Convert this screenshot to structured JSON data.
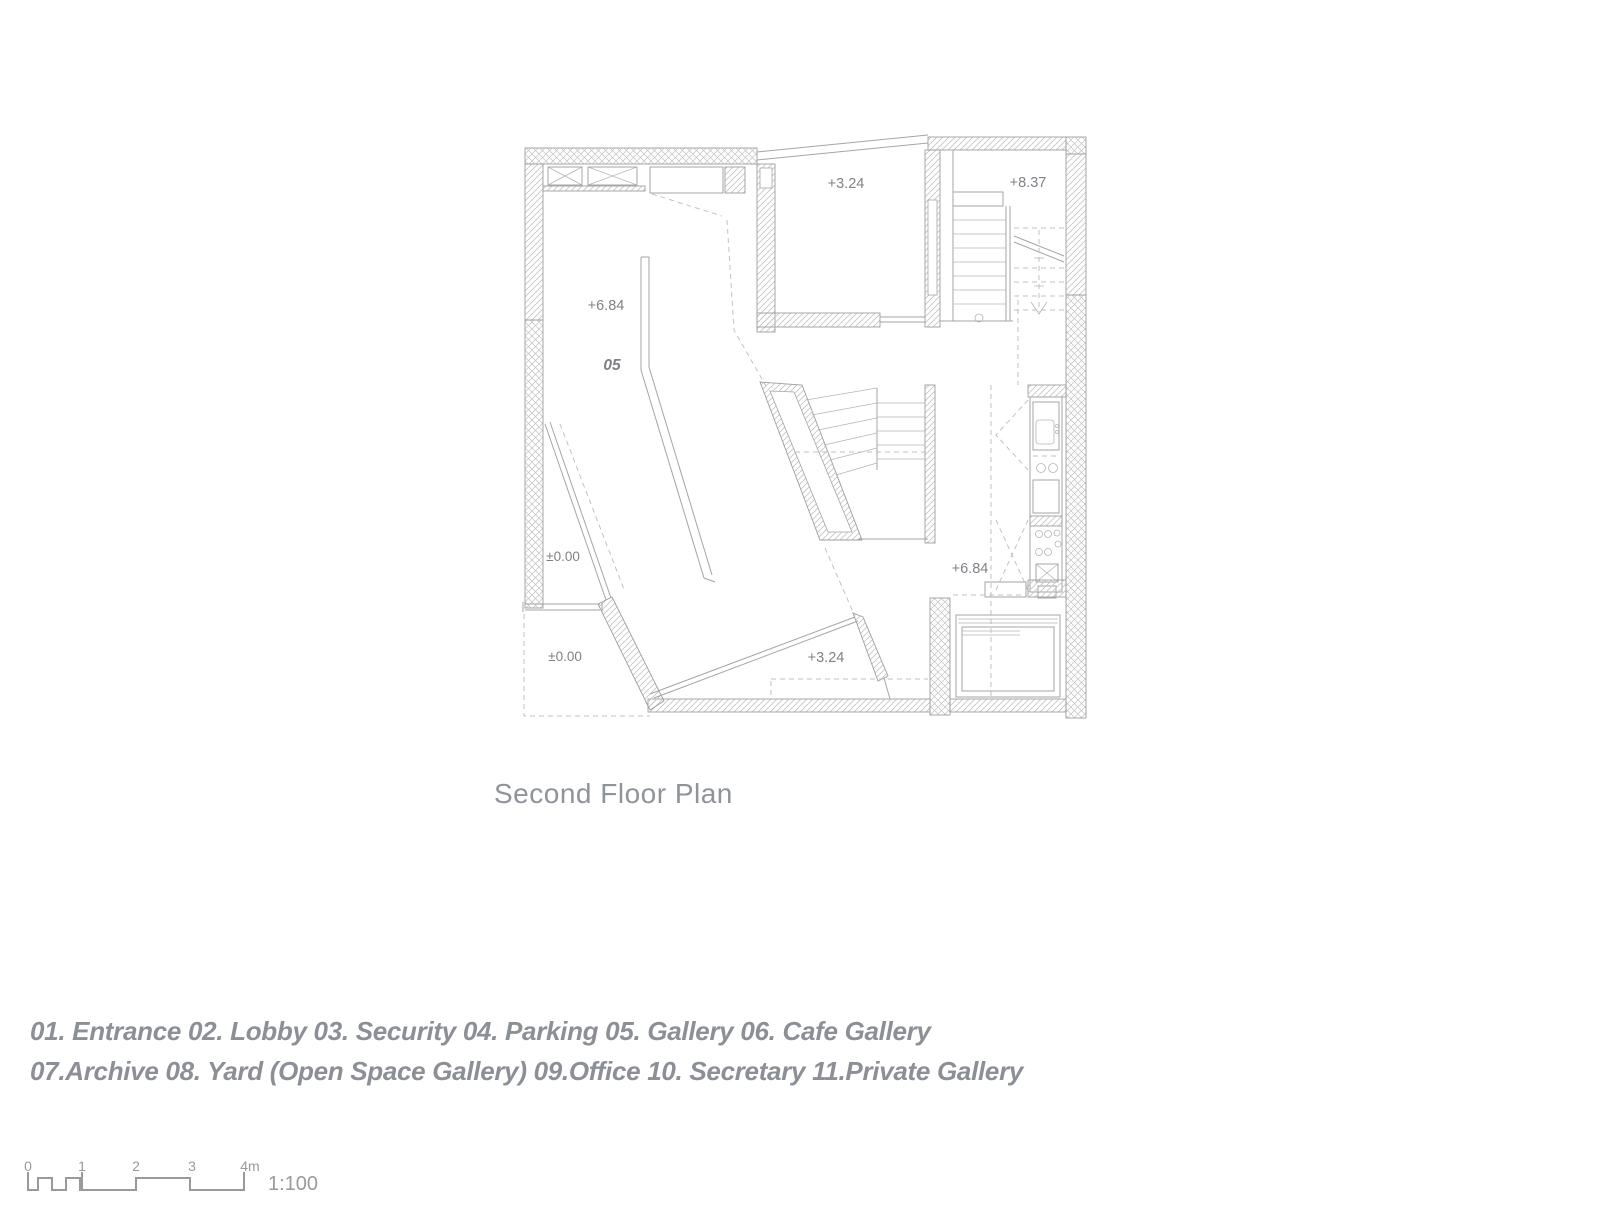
{
  "page": {
    "title": "Second Floor Plan"
  },
  "legend": {
    "line1": "01. Entrance 02. Lobby 03. Security 04. Parking 05. Gallery 06. Cafe Gallery",
    "line2": "07.Archive 08. Yard (Open Space Gallery) 09.Office 10. Secretary 11.Private Gallery"
  },
  "plan": {
    "labels": {
      "upper_room_level": "+3.24",
      "stair_level": "+8.37",
      "gallery_level": "+6.84",
      "gallery_room_number": "05",
      "ground_level_upper": "±0.00",
      "ground_level_lower": "±0.00",
      "right_hall_level": "+6.84",
      "bridge_level": "+3.24"
    }
  },
  "scale_bar": {
    "ticks": [
      "0",
      "1",
      "2",
      "3",
      "4m"
    ],
    "ratio": "1:100"
  },
  "colors": {
    "wall_line": "#9e9e9e",
    "hatch": "#c4c4c4",
    "label_text": "#7e8286",
    "title_text": "#8f949b",
    "legend_text": "#8c8f96"
  }
}
